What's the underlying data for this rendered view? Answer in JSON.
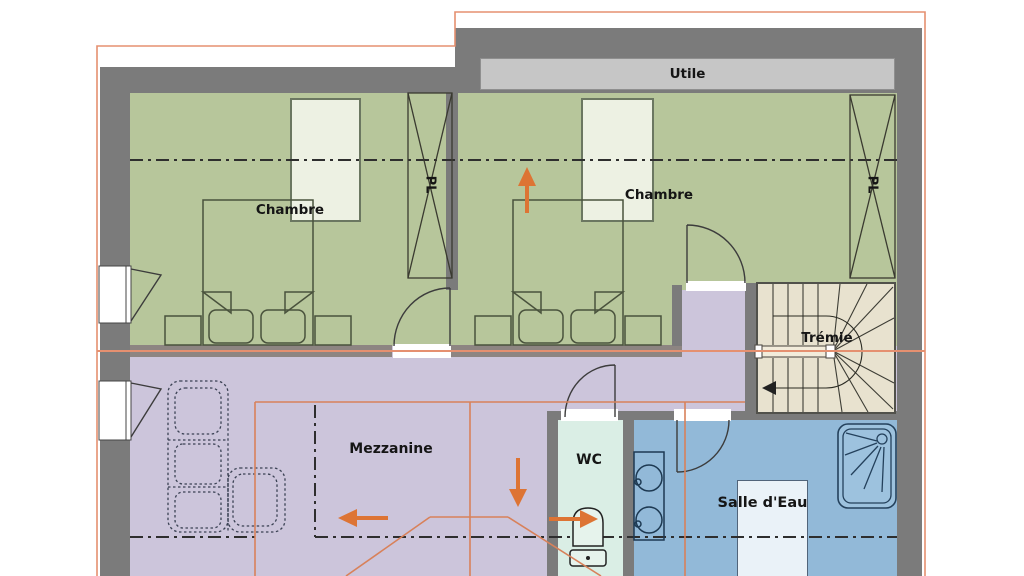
{
  "plan": {
    "labels": {
      "chambre1": "Chambre",
      "chambre2": "Chambre",
      "utile": "Utile",
      "tremie": "Trémie",
      "mezzanine": "Mezzanine",
      "wc": "WC",
      "salle_eau": "Salle d'Eau",
      "pl1": "PL",
      "pl2": "PL"
    },
    "colors": {
      "wall": "#7b7b7b",
      "bedroom": "#b7c69b",
      "mezzanine": "#ccc5db",
      "wc": "#daeee5",
      "bath": "#92b9d8",
      "stairs": "#e8e2cf",
      "utile_strip": "#c6c6c6",
      "velux": "#edf1e3",
      "bath_velux": "#eaf2f8",
      "orange_border": "#e59070",
      "orange_line": "#d8815a",
      "orange_arrow": "#dd7434",
      "line_dark": "#2e2e2e"
    }
  }
}
